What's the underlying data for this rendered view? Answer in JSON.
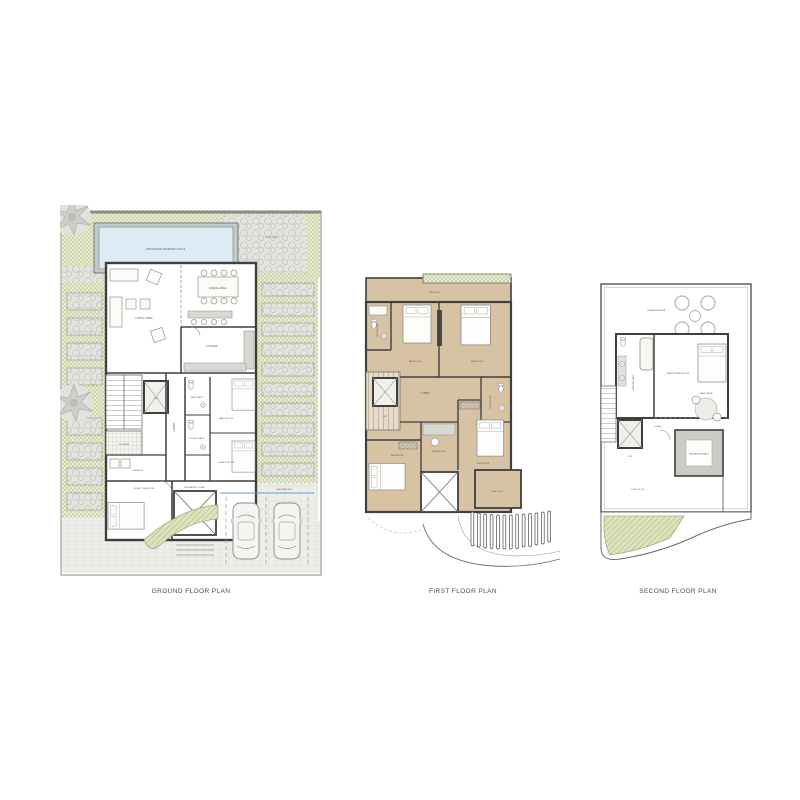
{
  "page": {
    "background": "#ffffff"
  },
  "plans": {
    "ground": {
      "title": "GROUND FLOOR PLAN",
      "rooms": {
        "pool": "PROPOSED SWIMMING POOL",
        "pool_deck": "POOL DECK",
        "living": "LIVING AREA",
        "dining": "DINING AREA",
        "kitchen": "KITCHEN",
        "lift": "LIFT",
        "lobby": "LOBBY",
        "powder": "POWDER",
        "laundry": "LAUNDRY",
        "maid_bath": "MAID BATH",
        "maid_room": "MAID ROOM",
        "guest_bath": "GUEST BATH",
        "guest_room": "GUEST ROOM",
        "guest_bedroom": "GUEST BEDROOM",
        "entrance": "ENTRANCE LOBBY",
        "parking": "CAR PARKING"
      }
    },
    "first": {
      "title": "FIRST FLOOR PLAN",
      "rooms": {
        "balcony": "BALCONY",
        "bedroom": "BEDROOM",
        "bathroom": "BATHROOM",
        "lobby": "LOBBY",
        "lift": "LIFT"
      }
    },
    "second": {
      "title": "SECOND FLOOR PLAN",
      "rooms": {
        "terrace": "TERRACE AREA",
        "master_bath": "MASTER BATH",
        "master_bedroom": "MASTER BEDROOM",
        "lift": "LIFT",
        "lobby": "LOBBY",
        "family": "FAMILY AREA",
        "dressing": "MASTER DRESSING",
        "roof": "FLAT ROOF"
      }
    }
  },
  "colors": {
    "lawn": "#e9ecd6",
    "lawn_dot": "#c9d2a4",
    "pool_water": "#dcecf4",
    "floor_tan": "#d8c2a4",
    "wall": "#3f3f3f",
    "paving": "#ededea",
    "planter_hatch": "#dde3bd",
    "shrub_gray": "#dedeD9",
    "accent_blue": "#4aa3d8"
  }
}
